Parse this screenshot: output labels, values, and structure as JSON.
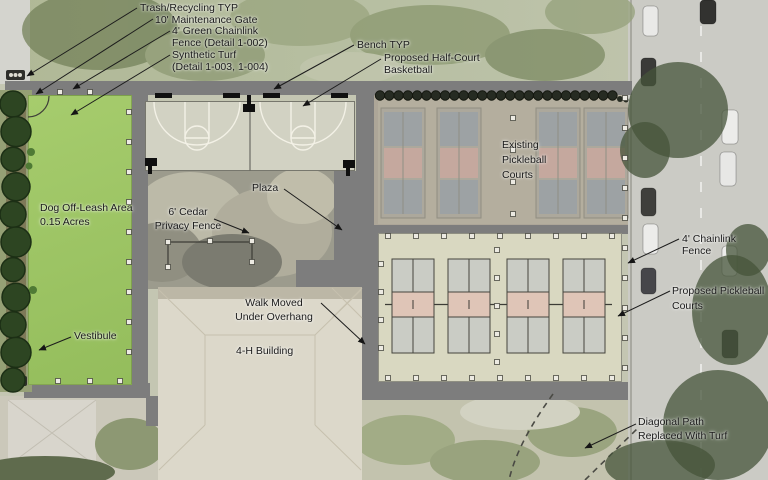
{
  "plan": {
    "labels": {
      "trash": "Trash/Recycling TYP",
      "maintenance_gate": "10' Maintenance Gate",
      "green_chainlink_fence": "4' Green Chainlink\nFence (Detail 1-002)",
      "synthetic_turf": "Synthetic Turf\n(Detail 1-003, 1-004)",
      "bench": "Bench TYP",
      "half_court": "Proposed Half-Court\nBasketball",
      "existing_courts": "Existing\nPickleball\nCourts",
      "chainlink_fence": "4' Chainlink Fence",
      "proposed_courts": "Proposed Pickleball\nCourts",
      "diagonal_path": "Diagonal Path\nReplaced With Turf",
      "dog_area": "Dog Off-Leash Area\n0.15 Acres",
      "vestibule": "Vestibule",
      "cedar_fence": "6' Cedar\nPrivacy Fence",
      "plaza": "Plaza",
      "walk": "Walk Moved\nUnder Overhang",
      "building": "4-H Building"
    },
    "icons": {
      "trash_receptacle": "three-bin trash/recycling symbol",
      "bench": "black bench bar",
      "basketball_hoop": "pole with backboard square"
    },
    "colors": {
      "path_gray": "#7d7d7d",
      "dog_turf_green": "#9cc161",
      "basketball_surface": "#d2d2c3",
      "proposed_court_bg": "#d9d8c1",
      "proposed_box_gray": "#caccc5",
      "kitchen_pink": "#dfc5b7",
      "existing_box_gray": "#9aa1a6",
      "existing_kitchen_pink": "#c9a89e",
      "label_text": "#1b1b1b"
    }
  }
}
